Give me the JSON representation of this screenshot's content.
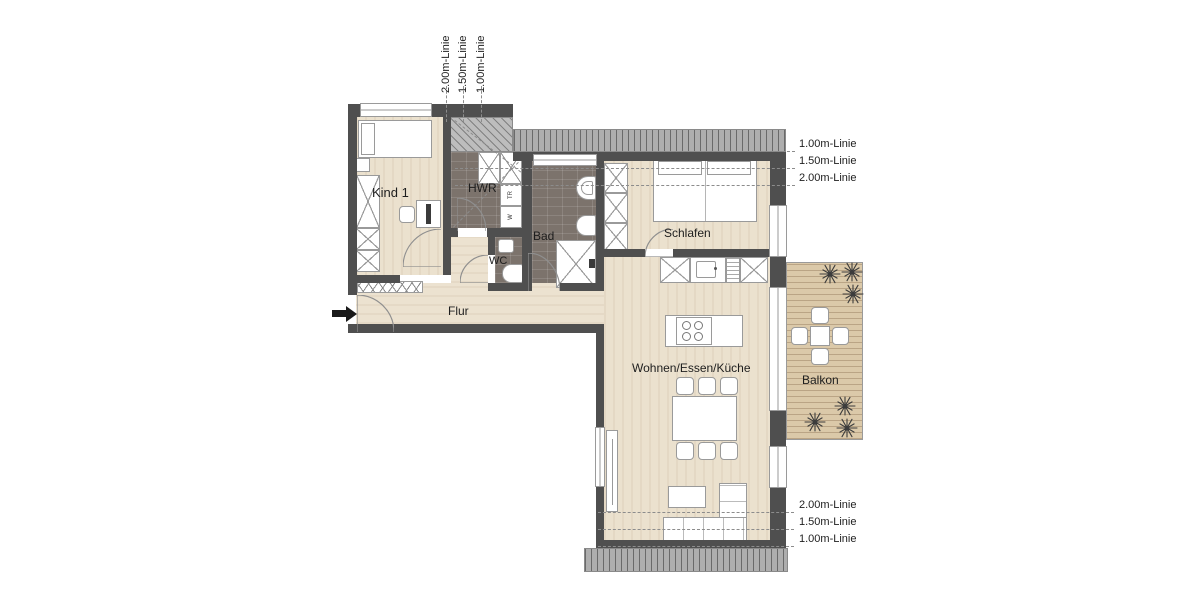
{
  "plan": {
    "rooms": {
      "kind1": "Kind 1",
      "hwr": "HWR",
      "bad": "Bad",
      "wc": "WC",
      "schlafen": "Schlafen",
      "flur": "Flur",
      "wohnen_essen_kueche": "Wohnen/Essen/Küche",
      "balkon": "Balkon"
    },
    "appliances": {
      "dryer": "TR",
      "washer": "W"
    },
    "height_lines": {
      "top": [
        "2.00m-Linie",
        "1.50m-Linie",
        "1.00m-Linie"
      ],
      "right_upper": [
        "1.00m-Linie",
        "1.50m-Linie",
        "2.00m-Linie"
      ],
      "right_lower": [
        "2.00m-Linie",
        "1.50m-Linie",
        "1.00m-Linie"
      ]
    },
    "colors": {
      "wall": "#4f4f4f",
      "wood_floor": "#ebe1ce",
      "tile_floor": "#7c736c",
      "balcony_deck": "#dbc9a9",
      "roof_hatch": "#aeaeae",
      "furniture_stroke": "#9a9a9a"
    }
  }
}
